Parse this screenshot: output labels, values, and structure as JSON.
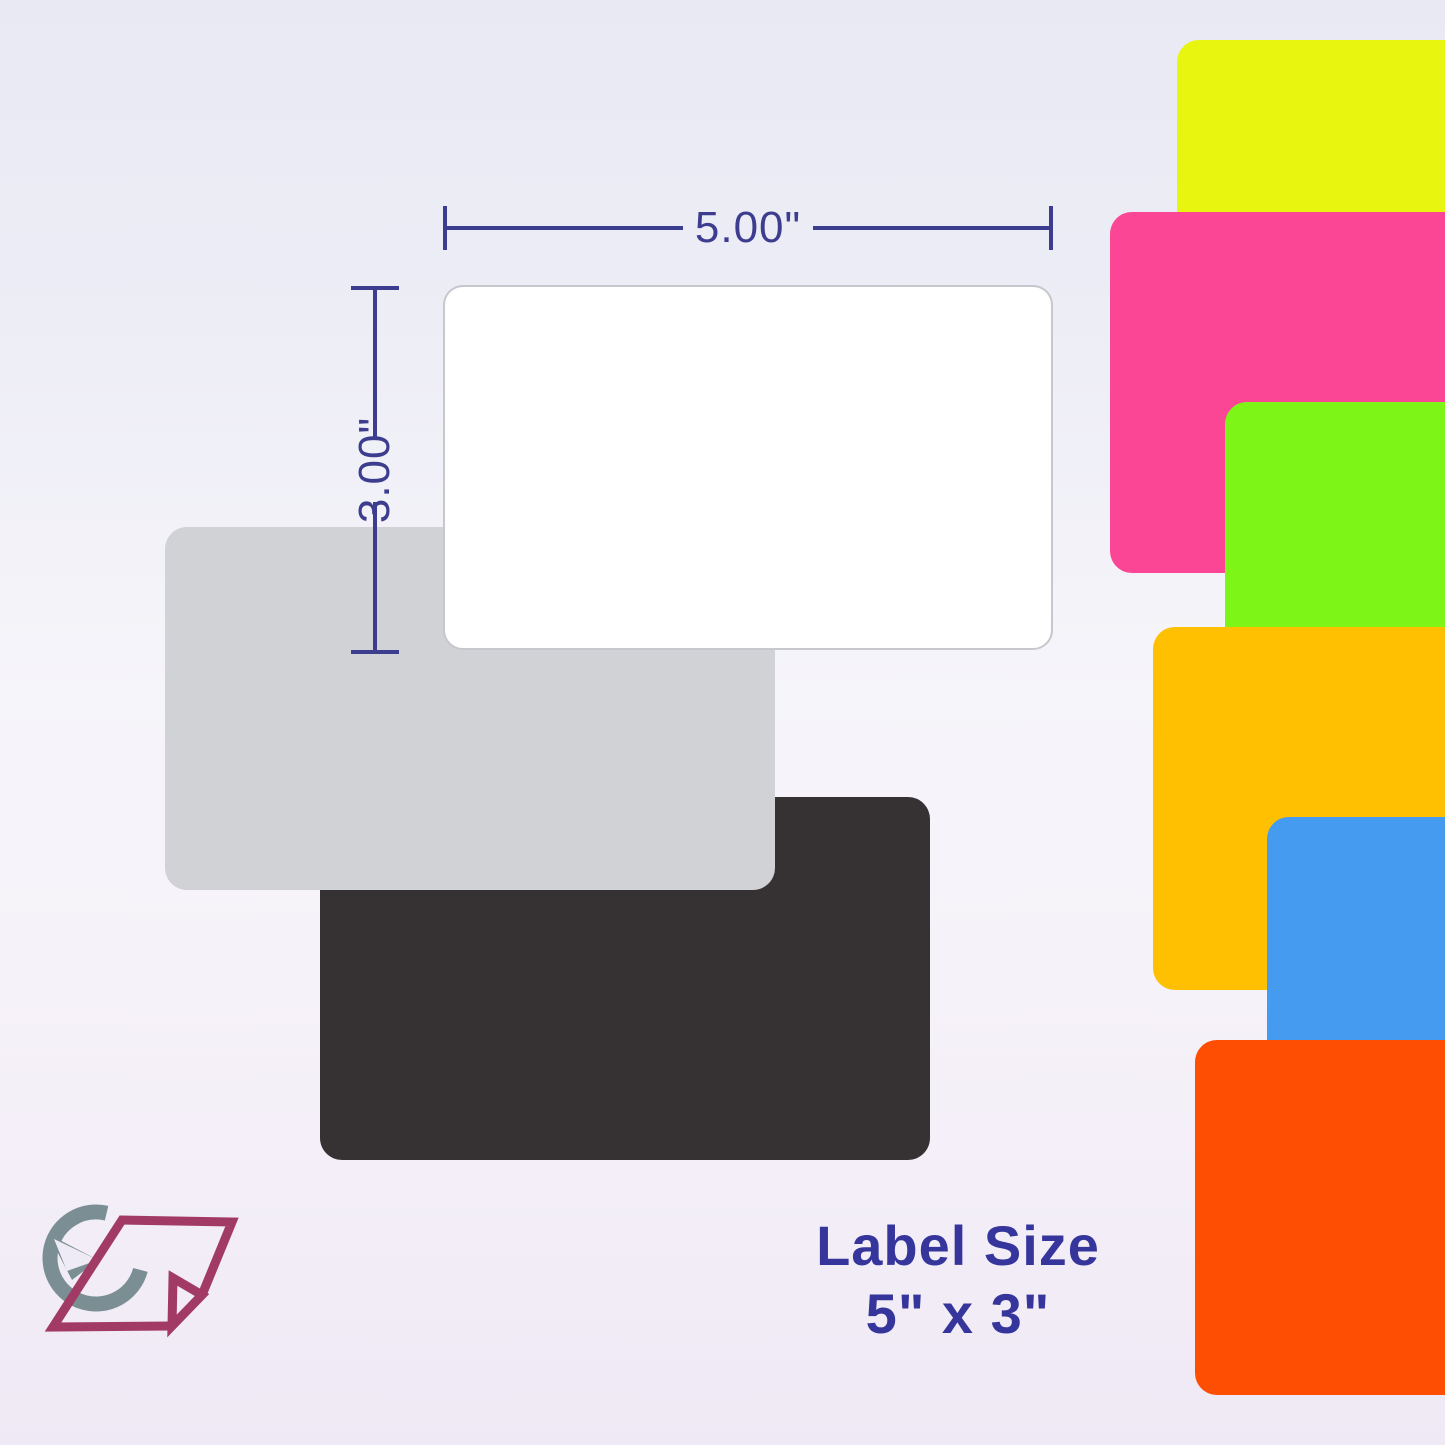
{
  "image": {
    "caption": {
      "line1": "Label Size",
      "line2": "5\" x 3\""
    },
    "dimensions": {
      "width_label": "5.00\"",
      "height_label": "3.00\""
    },
    "colors": {
      "accent_line": "#3d3d8f",
      "caption_text": "#35359b",
      "logo_gray": "#7b8e94",
      "logo_maroon": "#a23a66"
    },
    "main_labels": [
      {
        "name": "black label",
        "color": "#363133"
      },
      {
        "name": "gray label",
        "color": "#d1d2d6"
      },
      {
        "name": "white label",
        "color": "#ffffff"
      }
    ],
    "swatches": [
      {
        "name": "yellow label",
        "color": "#e8f50e"
      },
      {
        "name": "pink label",
        "color": "#fb4595"
      },
      {
        "name": "green label",
        "color": "#7df516"
      },
      {
        "name": "amber label",
        "color": "#ffc001"
      },
      {
        "name": "blue label",
        "color": "#459bef"
      },
      {
        "name": "orange-red label",
        "color": "#fe4e04"
      }
    ],
    "logo": {
      "name": "clock-label-logo"
    }
  }
}
